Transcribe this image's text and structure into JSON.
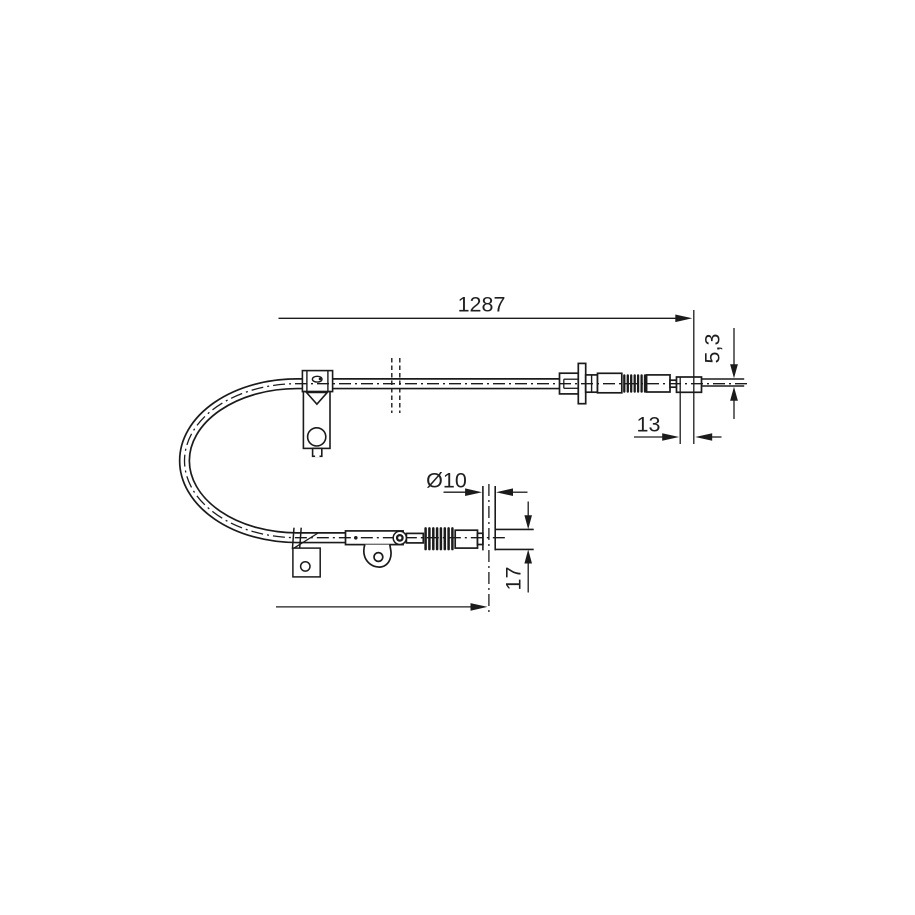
{
  "background": "#ffffff",
  "line_color": "#1b1b1b",
  "text_color": "#1f1f1f",
  "dimensions": {
    "overall_length": "1287",
    "end_offset": "13",
    "rod_diameter": "5,3",
    "barrel_diameter": "Ø10",
    "barrel_length": "17"
  }
}
